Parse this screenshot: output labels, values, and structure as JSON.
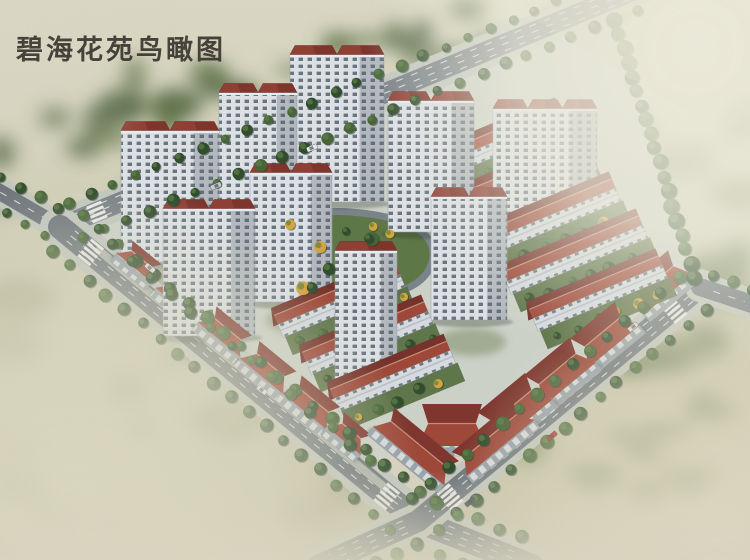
{
  "title": "碧海花苑鸟瞰图",
  "scene": {
    "label": "residential-compound-aerial-rendering",
    "palette": {
      "bg_top": "#d9d7c3",
      "bg_bottom": "#c2c1a3",
      "field_olive": "#9aa077",
      "field_green": "#6d7f52",
      "tree_dark": "#314c2e",
      "tree_mid": "#476539",
      "tree_light": "#5d7f46",
      "tree_yellow": "#d4a43e",
      "tree_orange": "#c57f2e",
      "road_asphalt": "#6e767c",
      "road_asphalt_light": "#798187",
      "road_line": "#eef0ea",
      "sidewalk": "#c1c6be",
      "ground": "#ccd1c8",
      "garden": "#5e7747",
      "plaza": "#d7d0bf",
      "tower_wall": "#dce0e4",
      "tower_shade": "#5a6570",
      "window": "#53626c",
      "roof_red": "#8f3f34",
      "roof_red_light": "#9d4839",
      "roof_red_dark": "#6f2d26",
      "roof_ridge": "#c58d77",
      "shop_wall": "#97a1a8",
      "car_red": "#b22a22",
      "haze": "#eceadb",
      "title_color": "#3a352e"
    }
  }
}
